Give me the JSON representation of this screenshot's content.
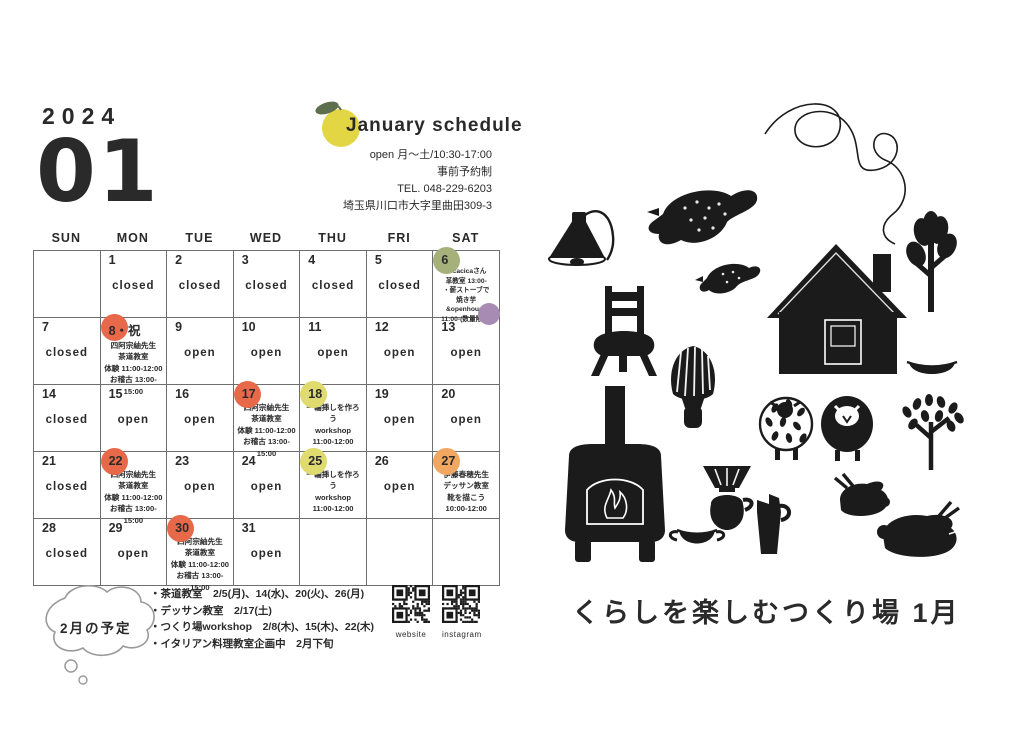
{
  "page": {
    "year": "2024",
    "month": "01"
  },
  "header": {
    "title": "January schedule",
    "info_lines": [
      "open 月〜土/10:30-17:00",
      "事前予約制",
      "TEL. 048-229-6203",
      "埼玉県川口市大字里曲田309-3"
    ]
  },
  "weekdays": [
    "SUN",
    "MON",
    "TUE",
    "WED",
    "THU",
    "FRI",
    "SAT"
  ],
  "colors": {
    "orange": "#e8694a",
    "yellow": "#dfdb6e",
    "green": "#a6b07b",
    "light_orange": "#f0a761",
    "purple": "#a88bb3",
    "fruit_yellow": "#e3d645",
    "leaf_green": "#5d6f4c"
  },
  "calendar": {
    "cells": [
      {
        "day": "",
        "status": "",
        "circle": "",
        "events": []
      },
      {
        "day": "1",
        "status": "closed",
        "circle": "",
        "events": []
      },
      {
        "day": "2",
        "status": "closed",
        "circle": "",
        "events": []
      },
      {
        "day": "3",
        "status": "closed",
        "circle": "",
        "events": []
      },
      {
        "day": "4",
        "status": "closed",
        "circle": "",
        "events": []
      },
      {
        "day": "5",
        "status": "closed",
        "circle": "",
        "events": []
      },
      {
        "day": "6",
        "status": "",
        "circle": "green",
        "events": [
          "・cacicaさん",
          "革教室 13:00-",
          "・薪ストーブで",
          "焼き芋&openhouse",
          "11:00-(数量限定)"
        ]
      },
      {
        "day": "7",
        "status": "closed",
        "circle": "",
        "events": []
      },
      {
        "day": "8",
        "suffix": "・祝",
        "status": "",
        "circle": "orange",
        "events": [
          "四阿宗紬先生",
          "茶道教室",
          "体験 11:00-12:00",
          "お稽古 13:00-15:00"
        ]
      },
      {
        "day": "9",
        "status": "open",
        "circle": "",
        "events": []
      },
      {
        "day": "10",
        "status": "open",
        "circle": "",
        "events": []
      },
      {
        "day": "11",
        "status": "open",
        "circle": "",
        "events": []
      },
      {
        "day": "12",
        "status": "open",
        "circle": "",
        "events": []
      },
      {
        "day": "13",
        "status": "open",
        "circle": "",
        "events": []
      },
      {
        "day": "14",
        "status": "closed",
        "circle": "",
        "events": []
      },
      {
        "day": "15",
        "status": "open",
        "circle": "",
        "events": []
      },
      {
        "day": "16",
        "status": "open",
        "circle": "",
        "events": []
      },
      {
        "day": "17",
        "status": "",
        "circle": "orange",
        "events": [
          "四阿宗紬先生",
          "茶道教室",
          "体験 11:00-12:00",
          "お稽古 13:00-15:00"
        ]
      },
      {
        "day": "18",
        "status": "",
        "circle": "yellow",
        "events": [
          "一輪挿しを作ろう",
          "workshop",
          "11:00-12:00"
        ]
      },
      {
        "day": "19",
        "status": "open",
        "circle": "",
        "events": []
      },
      {
        "day": "20",
        "status": "open",
        "circle": "",
        "events": []
      },
      {
        "day": "21",
        "status": "closed",
        "circle": "",
        "events": []
      },
      {
        "day": "22",
        "status": "",
        "circle": "orange",
        "events": [
          "四阿宗紬先生",
          "茶道教室",
          "体験 11:00-12:00",
          "お稽古 13:00-15:00"
        ]
      },
      {
        "day": "23",
        "status": "open",
        "circle": "",
        "events": []
      },
      {
        "day": "24",
        "status": "open",
        "circle": "",
        "events": []
      },
      {
        "day": "25",
        "status": "",
        "circle": "yellow",
        "events": [
          "一輪挿しを作ろう",
          "workshop",
          "11:00-12:00"
        ]
      },
      {
        "day": "26",
        "status": "open",
        "circle": "",
        "events": []
      },
      {
        "day": "27",
        "status": "",
        "circle": "light_orange",
        "events": [
          "伊藤春穂先生",
          "デッサン教室",
          "靴を描こう",
          "10:00-12:00"
        ]
      },
      {
        "day": "28",
        "status": "closed",
        "circle": "",
        "events": []
      },
      {
        "day": "29",
        "status": "open",
        "circle": "",
        "events": []
      },
      {
        "day": "30",
        "status": "",
        "circle": "orange",
        "events": [
          "四阿宗紬先生",
          "茶道教室",
          "体験 11:00-12:00",
          "お稽古 13:00-15:00"
        ]
      },
      {
        "day": "31",
        "status": "open",
        "circle": "",
        "events": []
      },
      {
        "day": "",
        "status": "",
        "circle": "",
        "events": []
      },
      {
        "day": "",
        "status": "",
        "circle": "",
        "events": []
      },
      {
        "day": "",
        "status": "",
        "circle": "",
        "events": []
      }
    ]
  },
  "february": {
    "bubble_label": "2月の予定",
    "notes": [
      "・茶道教室　2/5(月)、14(水)、20(火)、26(月)",
      "・デッサン教室　2/17(土)",
      "・つくり場workshop　2/8(木)、15(木)、22(木)",
      "・イタリアン料理教室企画中　2月下旬"
    ]
  },
  "qr": {
    "website_label": "website",
    "instagram_label": "instagram"
  },
  "footer_title": "くらしを楽しむつくり場 1月",
  "illustration_items": [
    "smoke-swirl",
    "hanging-lamp",
    "flying-bird",
    "small-bird",
    "chair",
    "house",
    "pine-tree",
    "tea-whisk",
    "bowl",
    "wood-stove",
    "spotted-sheep",
    "black-sheep",
    "leafy-tree",
    "coffee-dripper",
    "cup",
    "pitcher",
    "crouching-rabbit",
    "lying-rabbit"
  ]
}
